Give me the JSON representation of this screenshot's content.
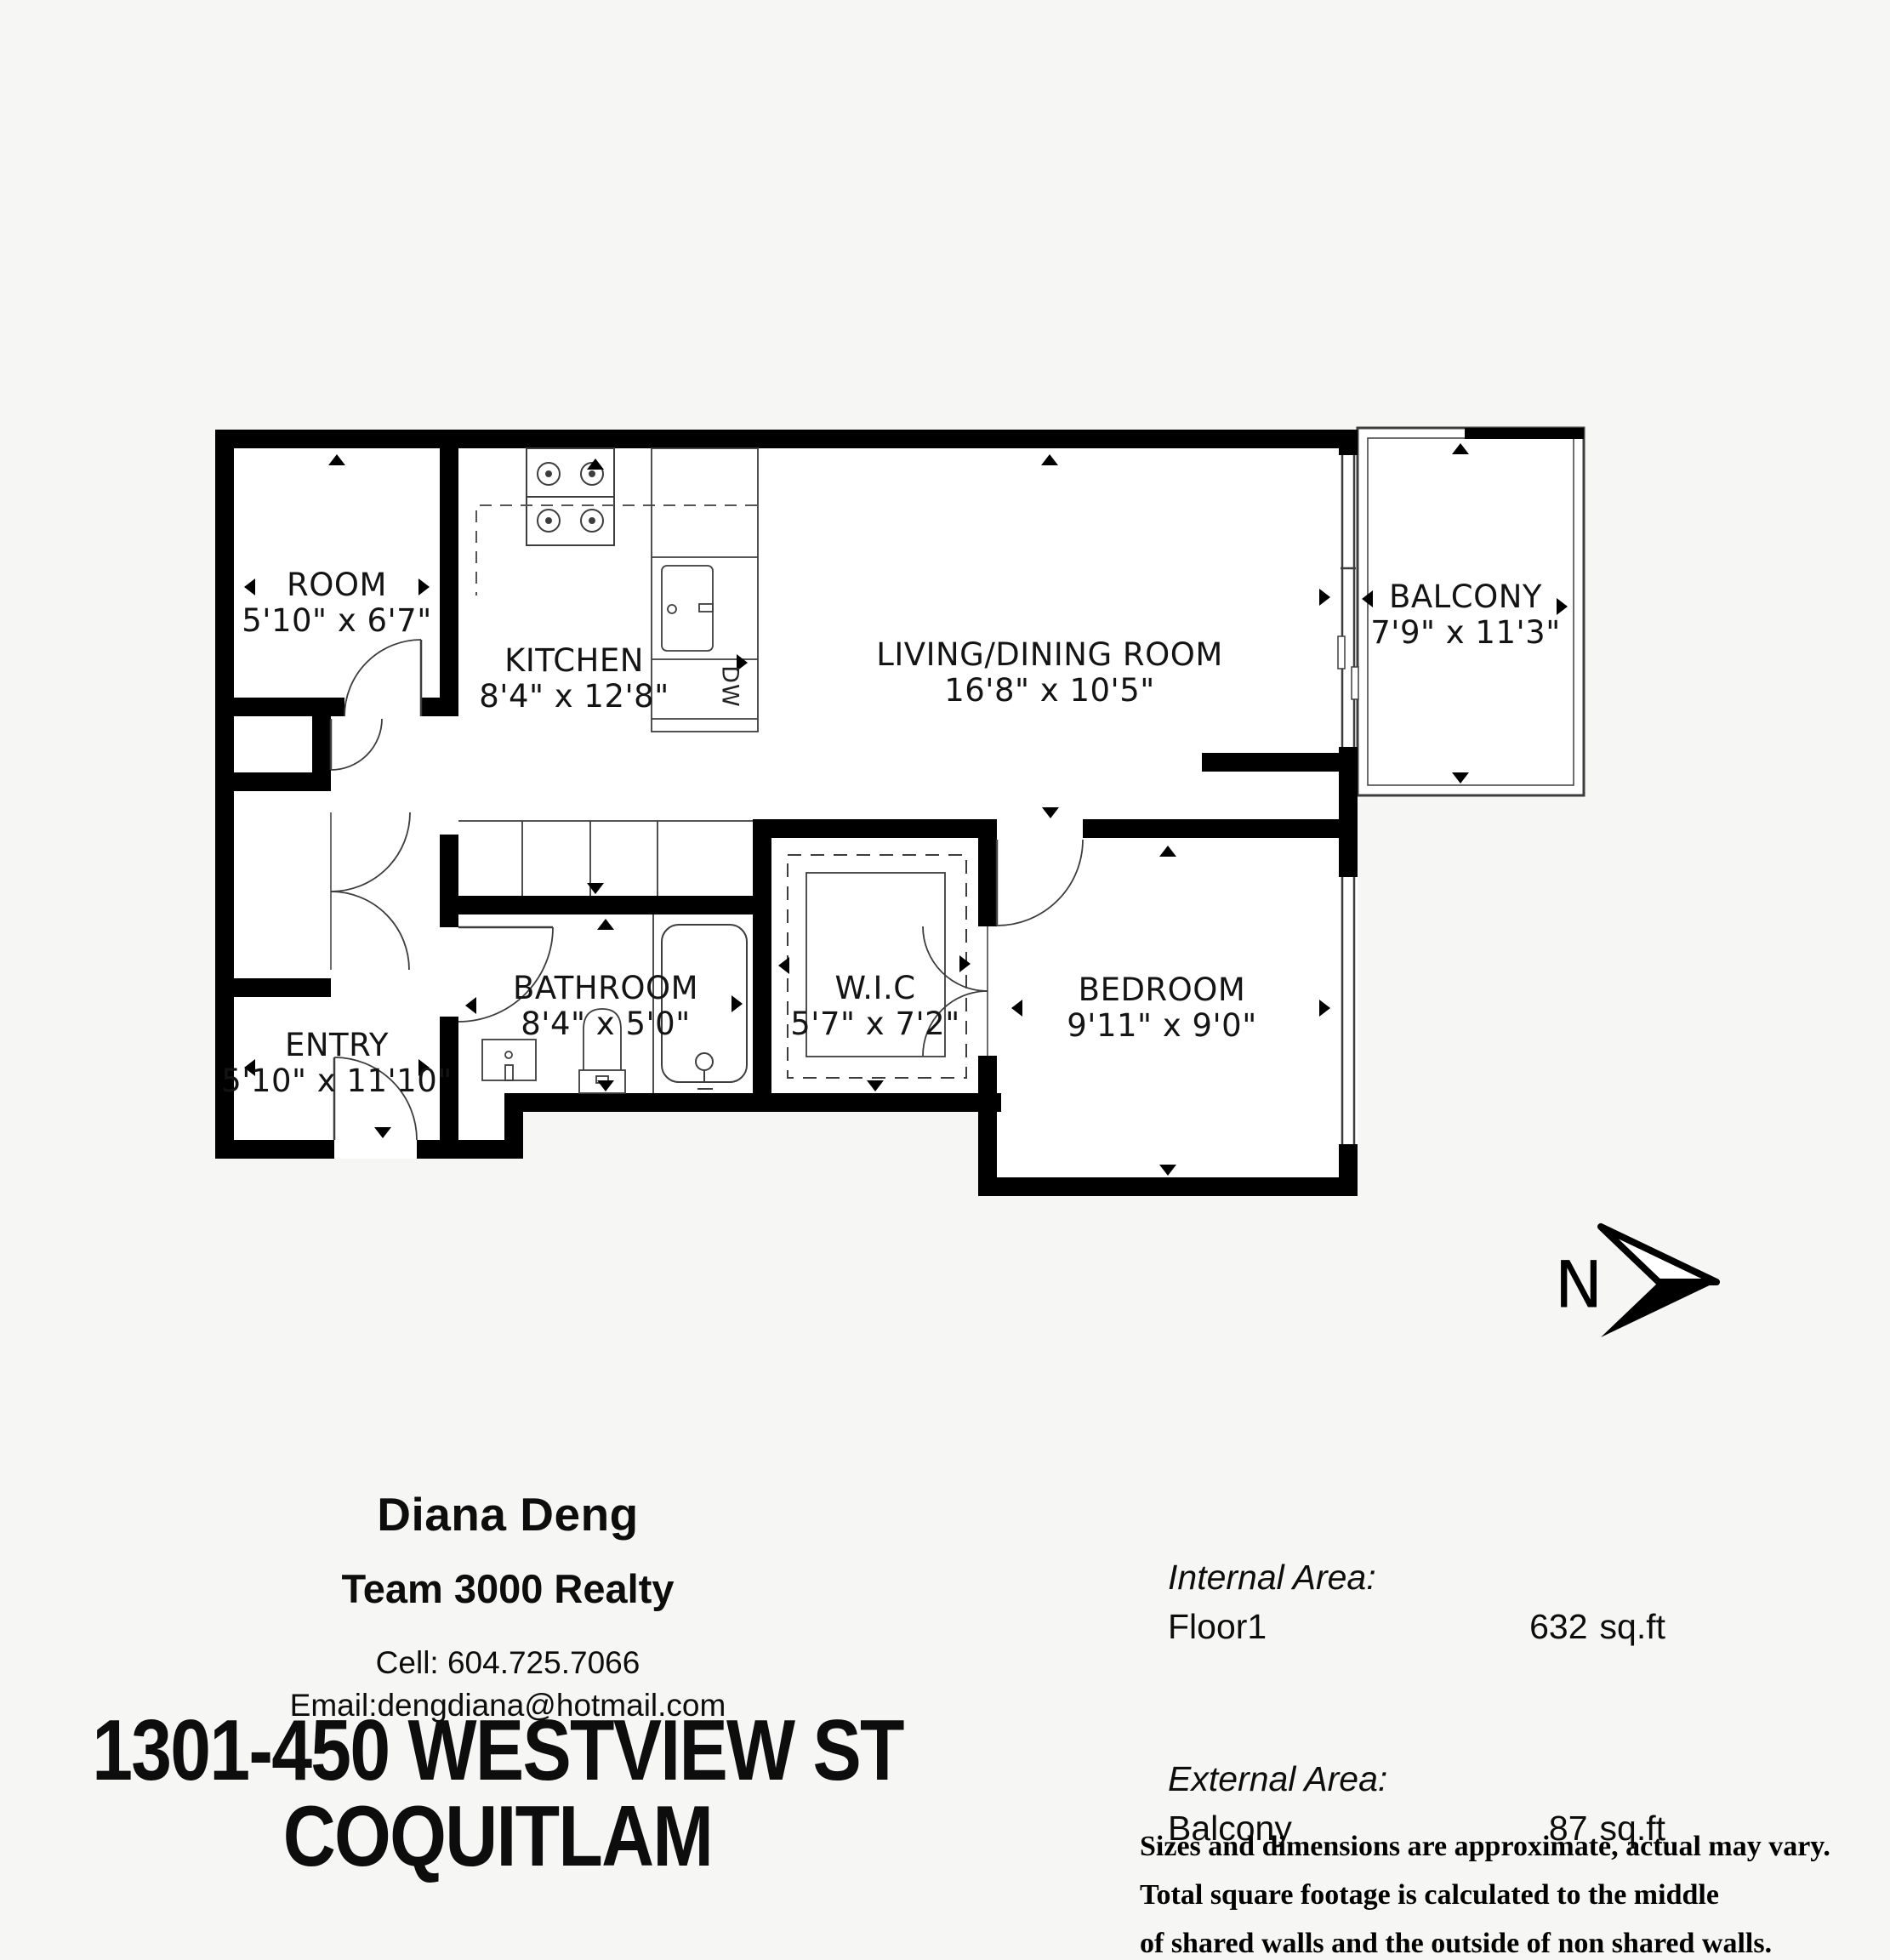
{
  "plan": {
    "rooms": {
      "room": {
        "name": "ROOM",
        "dims": "5'10\" x 6'7\""
      },
      "kitchen": {
        "name": "KITCHEN",
        "dims": "8'4\" x 12'8\""
      },
      "living": {
        "name": "LIVING/DINING ROOM",
        "dims": "16'8\" x 10'5\""
      },
      "balcony": {
        "name": "BALCONY",
        "dims": "7'9\" x 11'3\""
      },
      "bathroom": {
        "name": "BATHROOM",
        "dims": "8'4\" x 5'0\""
      },
      "wic": {
        "name": "W.I.C",
        "dims": "5'7\" x 7'2\""
      },
      "bedroom": {
        "name": "BEDROOM",
        "dims": "9'11\" x 9'0\""
      },
      "entry": {
        "name": "ENTRY",
        "dims": "5'10\" x 11'10\""
      }
    },
    "appliance_labels": {
      "dishwasher": "DW"
    },
    "north_label": "N"
  },
  "footer": {
    "agent": {
      "name": "Diana Deng",
      "brokerage": "Team 3000 Realty",
      "cell": "Cell: 604.725.7066",
      "email": "Email:dengdiana@hotmail.com"
    },
    "address": {
      "line1": "1301-450 WESTVIEW ST",
      "line2": "COQUITLAM"
    },
    "areas": {
      "internal_title": "Internal Area:",
      "internal_name": "Floor1",
      "internal_value": "632",
      "internal_unit": "sq.ft",
      "external_title": "External Area:",
      "external_name": "Balcony",
      "external_value": "87",
      "external_unit": "sq.ft"
    },
    "disclaimer": [
      "Sizes and dimensions are approximate, actual may vary.",
      "Total square footage is calculated to the middle",
      "of shared walls and the outside of non shared walls."
    ]
  },
  "colors": {
    "wall": "#000000",
    "background": "#f6f6f4",
    "room_fill": "#ffffff",
    "line": "#3d3d3d"
  }
}
